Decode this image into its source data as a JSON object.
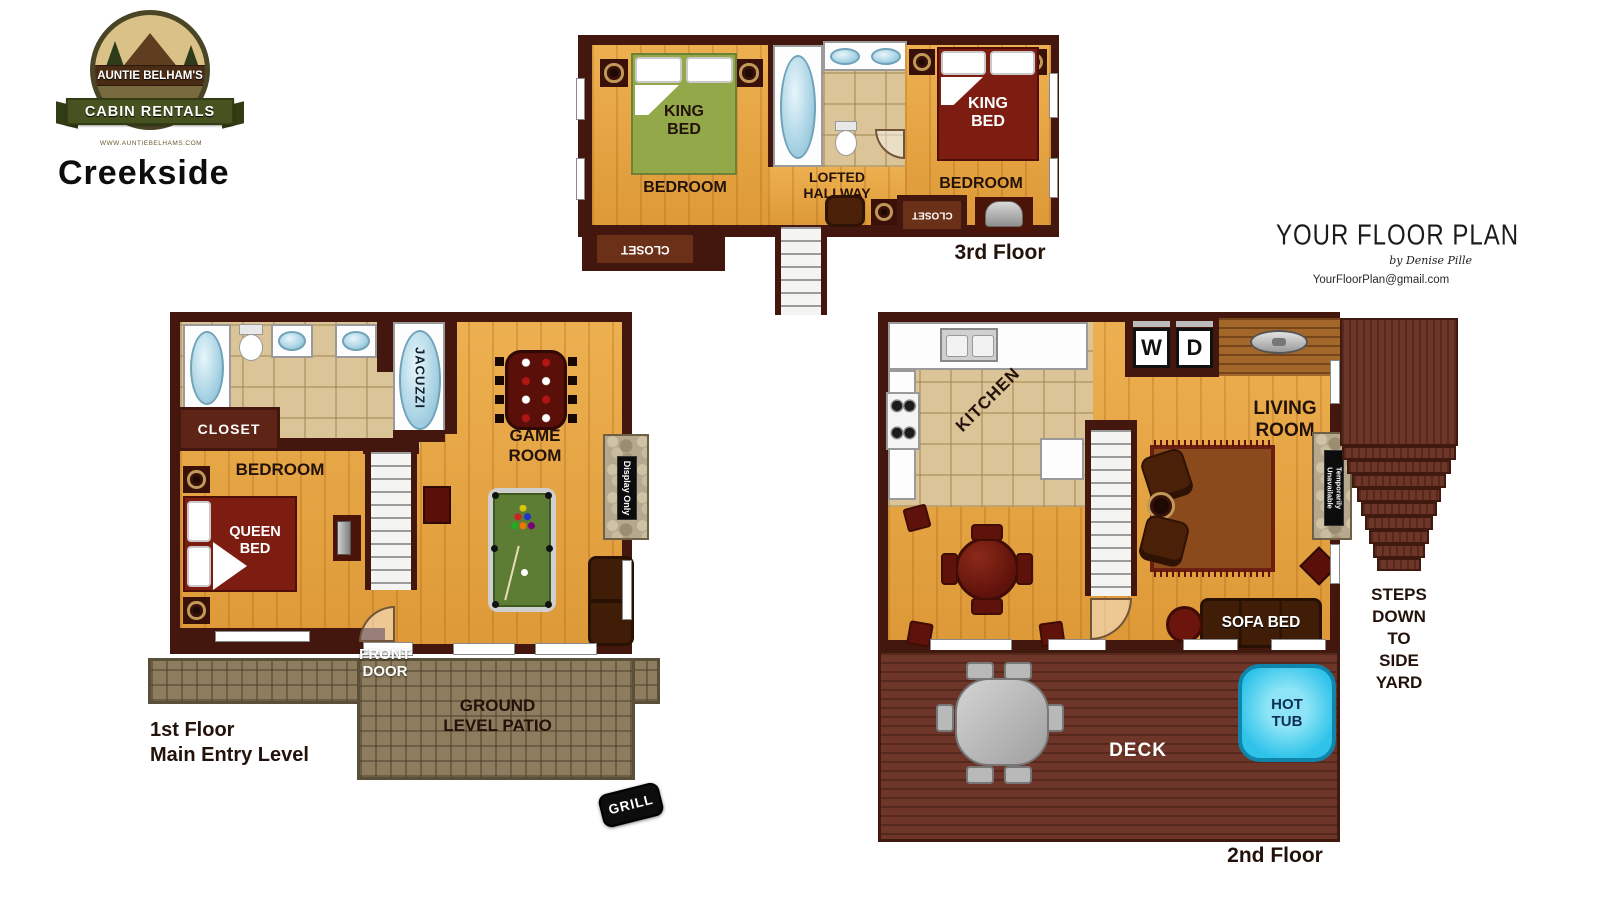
{
  "branding": {
    "arc_title": "AUNTIE BELHAM'S",
    "banner": "CABIN RENTALS",
    "subtitle": "SMOKY MOUNTAINS, TN",
    "website": "WWW.AUNTIEBELHAMS.COM",
    "cabin_name": "Creekside"
  },
  "credit": {
    "title": "YOUR FLOOR PLAN",
    "byline": "by Denise Pille",
    "email": "YourFloorPlan@gmail.com"
  },
  "floor3": {
    "floor_label": "3rd Floor",
    "left_bedroom": "BEDROOM",
    "left_bed": "KING\nBED",
    "left_closet": "CLOSET",
    "hallway": "LOFTED\nHALLWAY",
    "right_bedroom": "BEDROOM",
    "right_bed": "KING\nBED",
    "right_closet": "CLOSET"
  },
  "floor1": {
    "floor_label": "1st Floor\nMain Entry Level",
    "closet": "CLOSET",
    "bedroom": "BEDROOM",
    "bed": "QUEEN\nBED",
    "jacuzzi": "JACUZZI",
    "game_room": "GAME\nROOM",
    "fireplace_sign": "Display Only",
    "front_door": "FRONT\nDOOR",
    "patio": "GROUND\nLEVEL PATIO",
    "grill": "GRILL"
  },
  "floor2": {
    "floor_label": "2nd Floor",
    "kitchen": "KITCHEN",
    "washer": "W",
    "dryer": "D",
    "living_room": "LIVING\nROOM",
    "sofa_bed": "SOFA BED",
    "hot_tub": "HOT\nTUB",
    "deck": "DECK",
    "fireplace_sign": "Temporarily\nUnavailable",
    "steps_note": "STEPS\nDOWN\nTO\nSIDE\nYARD"
  },
  "colors": {
    "wall": "#44170e",
    "wood_floor": "#e9a53e",
    "dark_wood": "#a4672a",
    "tile": "#dbc497",
    "deck": "#6d3628",
    "patio_stone": "#8d7c5e",
    "bed_red": "#7d1d12",
    "bed_green": "#93a849",
    "hot_tub_blue": "#2fc3ea",
    "fixture_blue": "#a9d3e4"
  }
}
